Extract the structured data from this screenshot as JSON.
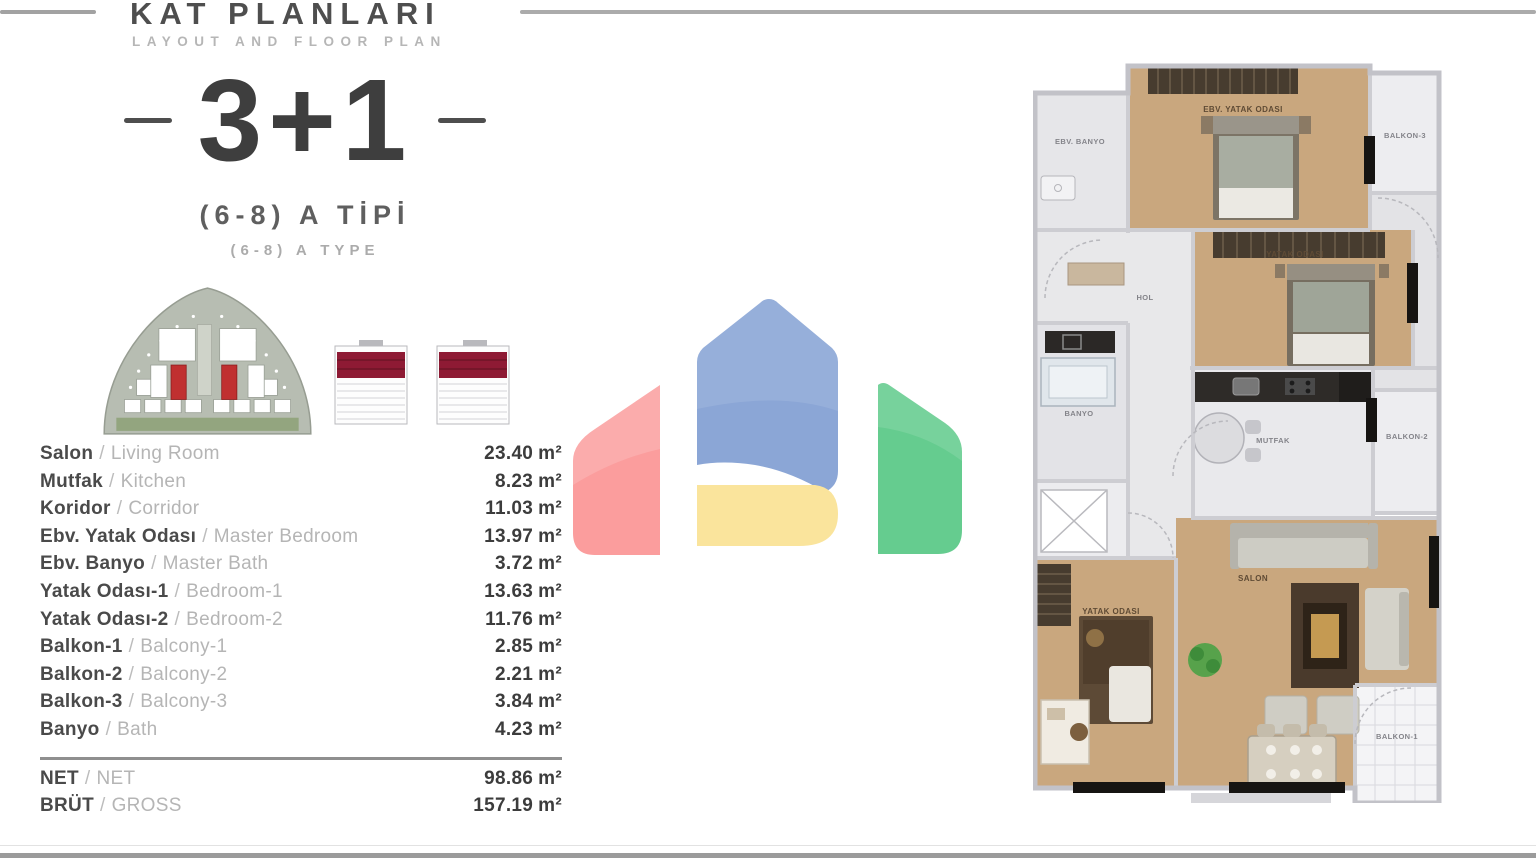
{
  "header": {
    "title": "KAT PLANLARI",
    "subtitle": "LAYOUT AND FLOOR PLAN"
  },
  "unit": {
    "rooms": "3+1",
    "type_tr": "(6-8) A TİPİ",
    "type_en": "(6-8) A TYPE"
  },
  "areas": {
    "separator": "/",
    "unit": "m²",
    "rows": [
      {
        "tr": "Salon",
        "en": "Living Room",
        "value": "23.40"
      },
      {
        "tr": "Mutfak",
        "en": "Kitchen",
        "value": "8.23"
      },
      {
        "tr": "Koridor",
        "en": "Corridor",
        "value": "11.03"
      },
      {
        "tr": "Ebv. Yatak Odası",
        "en": "Master Bedroom",
        "value": "13.97"
      },
      {
        "tr": "Ebv. Banyo",
        "en": "Master Bath",
        "value": "3.72"
      },
      {
        "tr": "Yatak Odası-1",
        "en": "Bedroom-1",
        "value": "13.63"
      },
      {
        "tr": "Yatak Odası-2",
        "en": "Bedroom-2",
        "value": "11.76"
      },
      {
        "tr": "Balkon-1",
        "en": "Balcony-1",
        "value": "2.85"
      },
      {
        "tr": "Balkon-2",
        "en": "Balcony-2",
        "value": "2.21"
      },
      {
        "tr": "Balkon-3",
        "en": "Balcony-3",
        "value": "3.84"
      },
      {
        "tr": "Banyo",
        "en": "Bath",
        "value": "4.23"
      }
    ],
    "totals": [
      {
        "tr": "NET",
        "en": "NET",
        "value": "98.86"
      },
      {
        "tr": "BRÜT",
        "en": "GROSS",
        "value": "157.19"
      }
    ]
  },
  "floor_plan": {
    "labels": {
      "ebv_banyo": "EBV. BANYO",
      "ebv_yatak_odasi": "EBV. YATAK ODASI",
      "balkon_3": "BALKON-3",
      "hol": "HOL",
      "yatak_odasi_2": "YATAK ODASI",
      "banyo": "BANYO",
      "mutfak": "MUTFAK",
      "balkon_2": "BALKON-2",
      "yatak_odasi_1": "YATAK ODASI",
      "salon": "SALON",
      "balkon_1": "BALKON-1"
    }
  },
  "colors": {
    "logo_blue": "#8BA6D6",
    "logo_red": "#FB9D9D",
    "logo_green": "#65CC8F",
    "logo_yellow": "#FAE49C",
    "elevation_band": "#8E1A34"
  }
}
